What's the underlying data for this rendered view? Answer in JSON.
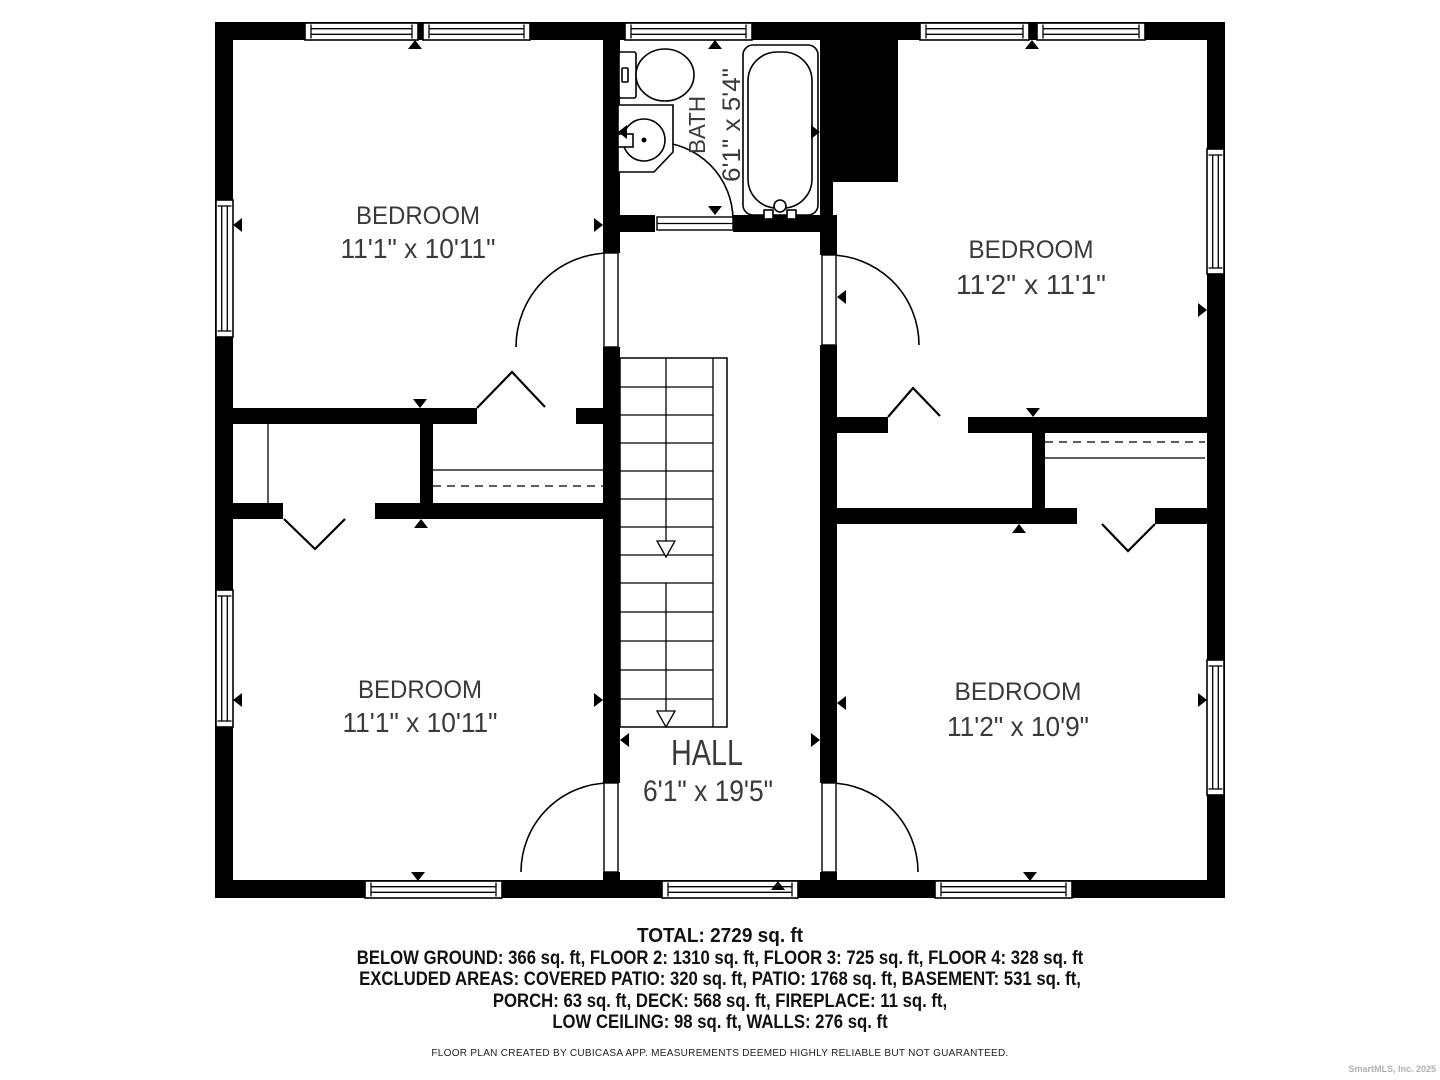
{
  "plan": {
    "rooms": [
      {
        "id": "bedroom-top-left",
        "name": "BEDROOM",
        "dims": "11'1\" x 10'11\""
      },
      {
        "id": "bedroom-top-right",
        "name": "BEDROOM",
        "dims": "11'2\" x 11'1\""
      },
      {
        "id": "bedroom-bottom-left",
        "name": "BEDROOM",
        "dims": "11'1\" x 10'11\""
      },
      {
        "id": "bedroom-bottom-right",
        "name": "BEDROOM",
        "dims": "11'2\" x 10'9\""
      },
      {
        "id": "hall",
        "name": "HALL",
        "dims": "6'1\" x 19'5\""
      },
      {
        "id": "bath",
        "name": "BATH",
        "dims": "6'1\" x 5'4\""
      }
    ]
  },
  "footer": {
    "total": "TOTAL: 2729 sq. ft",
    "lines": [
      "BELOW GROUND: 366 sq. ft, FLOOR 2: 1310 sq. ft, FLOOR 3: 725 sq. ft, FLOOR 4: 328 sq. ft",
      "EXCLUDED AREAS: COVERED PATIO: 320 sq. ft, PATIO: 1768 sq. ft, BASEMENT: 531 sq. ft,",
      "PORCH: 63 sq. ft, DECK: 568 sq. ft, FIREPLACE: 11 sq. ft,",
      "LOW CEILING: 98 sq. ft, WALLS: 276 sq. ft"
    ],
    "attribution": "FLOOR PLAN CREATED BY CUBICASA APP. MEASUREMENTS DEEMED HIGHLY RELIABLE BUT NOT GUARANTEED.",
    "watermark": "SmartMLS, Inc.  2025"
  },
  "colors": {
    "wall": "#000000",
    "label": "#3a3a3a",
    "footer_text": "#111111",
    "watermark": "#b0b0b0"
  }
}
